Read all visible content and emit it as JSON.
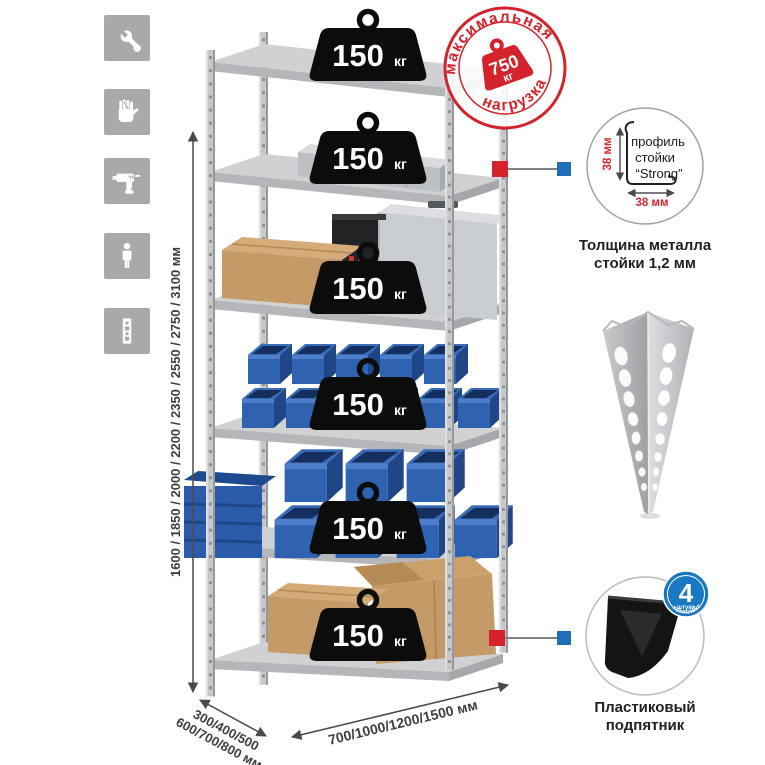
{
  "shelf_weights": [
    {
      "value": "150",
      "unit": "кг"
    },
    {
      "value": "150",
      "unit": "кг"
    },
    {
      "value": "150",
      "unit": "кг"
    },
    {
      "value": "150",
      "unit": "кг"
    },
    {
      "value": "150",
      "unit": "кг"
    },
    {
      "value": "150",
      "unit": "кг"
    }
  ],
  "max_load": {
    "arc_top": "максимальная",
    "arc_bottom": "нагрузка",
    "value": "750",
    "unit": "кг"
  },
  "height_dimensions": "1600 / 1850 / 2000 / 2200 / 2350 / 2550 / 2750 / 3100 мм",
  "depth_dimensions": {
    "line1": "300/400/500",
    "line2": "600/700/800 мм"
  },
  "width_dimensions": "700/1000/1200/1500 мм",
  "profile_callout": {
    "label_line1": "профиль",
    "label_line2": "стойки",
    "label_line3": "“Strong”",
    "vertical_dim": "38 мм",
    "horizontal_dim": "38 мм",
    "caption_line1": "Толщина металла",
    "caption_line2": "стойки 1,2 мм"
  },
  "foot_callout": {
    "badge_number": "4",
    "badge_unit": "штуки",
    "badge_arc": "в комплекте",
    "caption_line1": "Пластиковый",
    "caption_line2": "подпятник"
  },
  "icons": [
    {
      "name": "wrench-icon"
    },
    {
      "name": "gloves-icon"
    },
    {
      "name": "drill-icon"
    },
    {
      "name": "person-icon"
    },
    {
      "name": "rack-post-icon"
    }
  ],
  "colors": {
    "accent_red": "#d5232b",
    "accent_blue": "#1e6fb8",
    "bin_blue": "#2a5cab",
    "metal_gray": "#c9cbcd",
    "icon_bg": "#a7a9ab",
    "cardboard": "#c49a67",
    "text": "#3f3f3f"
  }
}
